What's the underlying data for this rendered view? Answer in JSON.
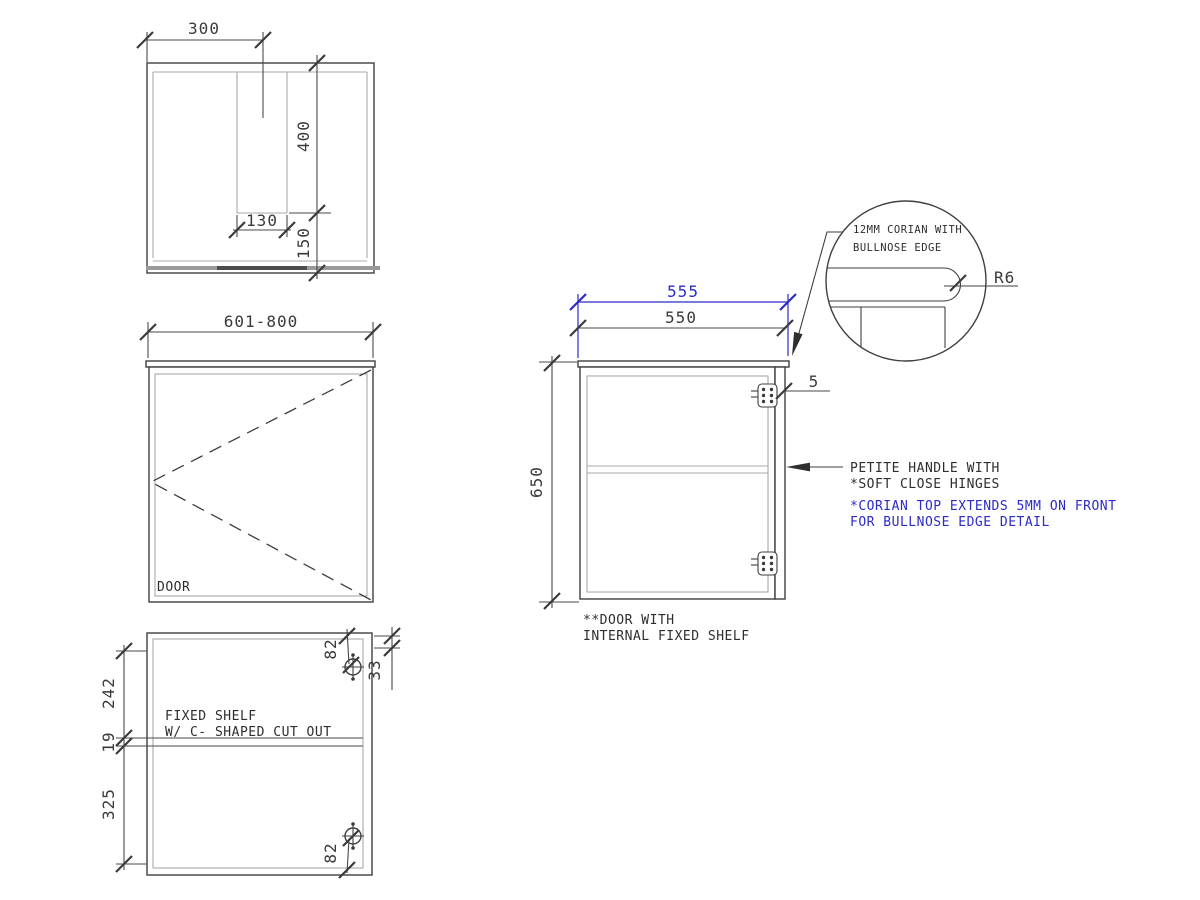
{
  "colors": {
    "accent_blue": "#2b2bc8",
    "line": "#3f3f3f",
    "light_line": "#a8a8a8",
    "background": "#ffffff"
  },
  "plan_view": {
    "dim_width_to_cutout": "300",
    "dim_cutout_depth": "400",
    "dim_cutout_width": "130",
    "dim_cutout_to_front": "150"
  },
  "front_view": {
    "dim_width_range": "601-800",
    "door_label": "DOOR"
  },
  "internal_view": {
    "dim_top_to_shelf": "242",
    "dim_shelf_thickness": "19",
    "dim_shelf_to_bottom": "325",
    "dim_hinge_top_offset": "82",
    "dim_hinge_side_offset": "33",
    "dim_hinge_bottom_offset": "82",
    "shelf_note_line1": "FIXED SHELF",
    "shelf_note_line2": "W/ C- SHAPED CUT OUT"
  },
  "side_view": {
    "dim_top_depth": "555",
    "dim_carcass_depth": "550",
    "dim_height": "650",
    "dim_overhang": "5",
    "note_line1": "**DOOR WITH",
    "note_line2": "INTERNAL FIXED SHELF"
  },
  "detail_view": {
    "note_line1": "12MM CORIAN WITH",
    "note_line2": "BULLNOSE EDGE",
    "radius_label": "R6"
  },
  "annotations": {
    "handle_line1": "PETITE HANDLE WITH",
    "handle_line2": "*SOFT CLOSE HINGES",
    "corian_line1": "*CORIAN TOP EXTENDS 5MM ON FRONT",
    "corian_line2": "FOR BULLNOSE EDGE DETAIL"
  }
}
